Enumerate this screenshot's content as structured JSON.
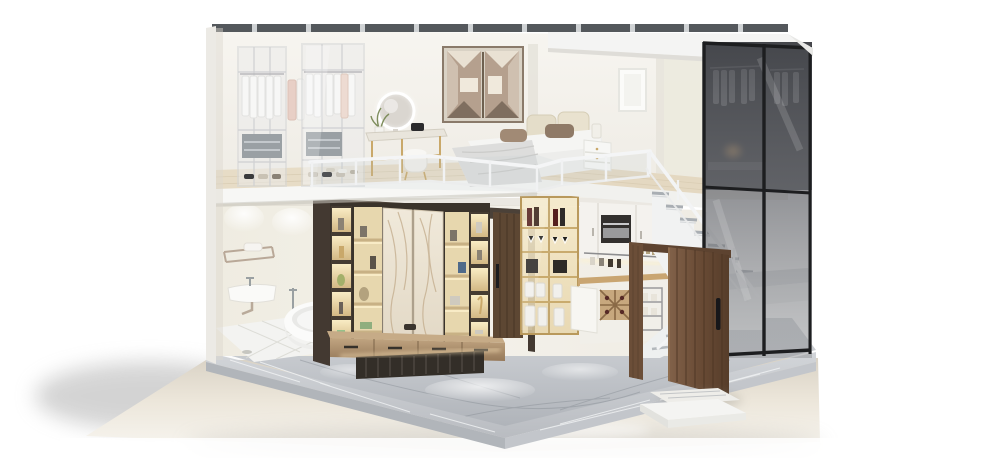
{
  "meta": {
    "title": "Loft apartment cutaway render",
    "description": "Cutaway 3D render of a two-story loft apartment on a grey marble plinth: upstairs bedroom with glass-front wardrobes, hanging white clothes, LED vanity mirror, low bed with beige headboard cushions and a geometric bronze mirror niche behind a white glass railing; downstairs bathroom with towel rail, wall basin and freestanding tub, a backlit walnut-and-marble media feature wall with floating console, a kitchenette with gold-framed glass display cabinet and built-in oven, a white staircase with marble treads, an open walnut entry door with step, and a full-height smoked-glass walk-in closet with black frames."
  },
  "palette": {
    "background": "#ffffff",
    "ground": "#e9e3d7",
    "ground_shadow": "#a9a9a9",
    "plinth_marble": "#c2c6cb",
    "interior_floor": "#c6cacf",
    "wall_white": "#f3f1ec",
    "wall_cream": "#efece2",
    "roof_strip": "#54585c",
    "slab_white": "#f6f6f4",
    "wood_floor": "#e6dbc5",
    "railing_white": "#f3f4f5",
    "tv_frame_brown": "#4a4038",
    "niche_glow": "#f3e2b6",
    "marble_panel": "#ebe3d3",
    "console_wood": "#ab8f6d",
    "walnut_door": "#6e5038",
    "gold_frame": "#b9995c",
    "glass_smoke": "#5c5e63",
    "glass_frame_black": "#1d1e20",
    "stair_white": "#f1f2f2",
    "stair_tread": "#b6babf",
    "tub_white": "#fafafa",
    "led_warm": "#ffedc2",
    "bed_beige": "#e3dcc8",
    "pillow_taupe": "#9b8571"
  },
  "scene": {
    "upper_level": [
      "glass-front wardrobes with white clothes",
      "vanity with round LED mirror and pouf",
      "low bed with beige cushions and taupe pillows",
      "bronze geometric mirror niche",
      "white framed picture",
      "white glass railing"
    ],
    "lower_level": [
      "bathroom with towel rail, basin and freestanding tub",
      "backlit media feature wall with marble sliding panels",
      "floating wood media console",
      "closed walnut interior door",
      "gold-framed glass display cabinet",
      "kitchenette with built-in oven and wine rack",
      "white staircase with marble treads",
      "open walnut entry door with outside step"
    ],
    "envelope": [
      "smoked glass walk-in closet wall",
      "grey marble plinth",
      "glossy beige ground with soft shadow"
    ]
  }
}
